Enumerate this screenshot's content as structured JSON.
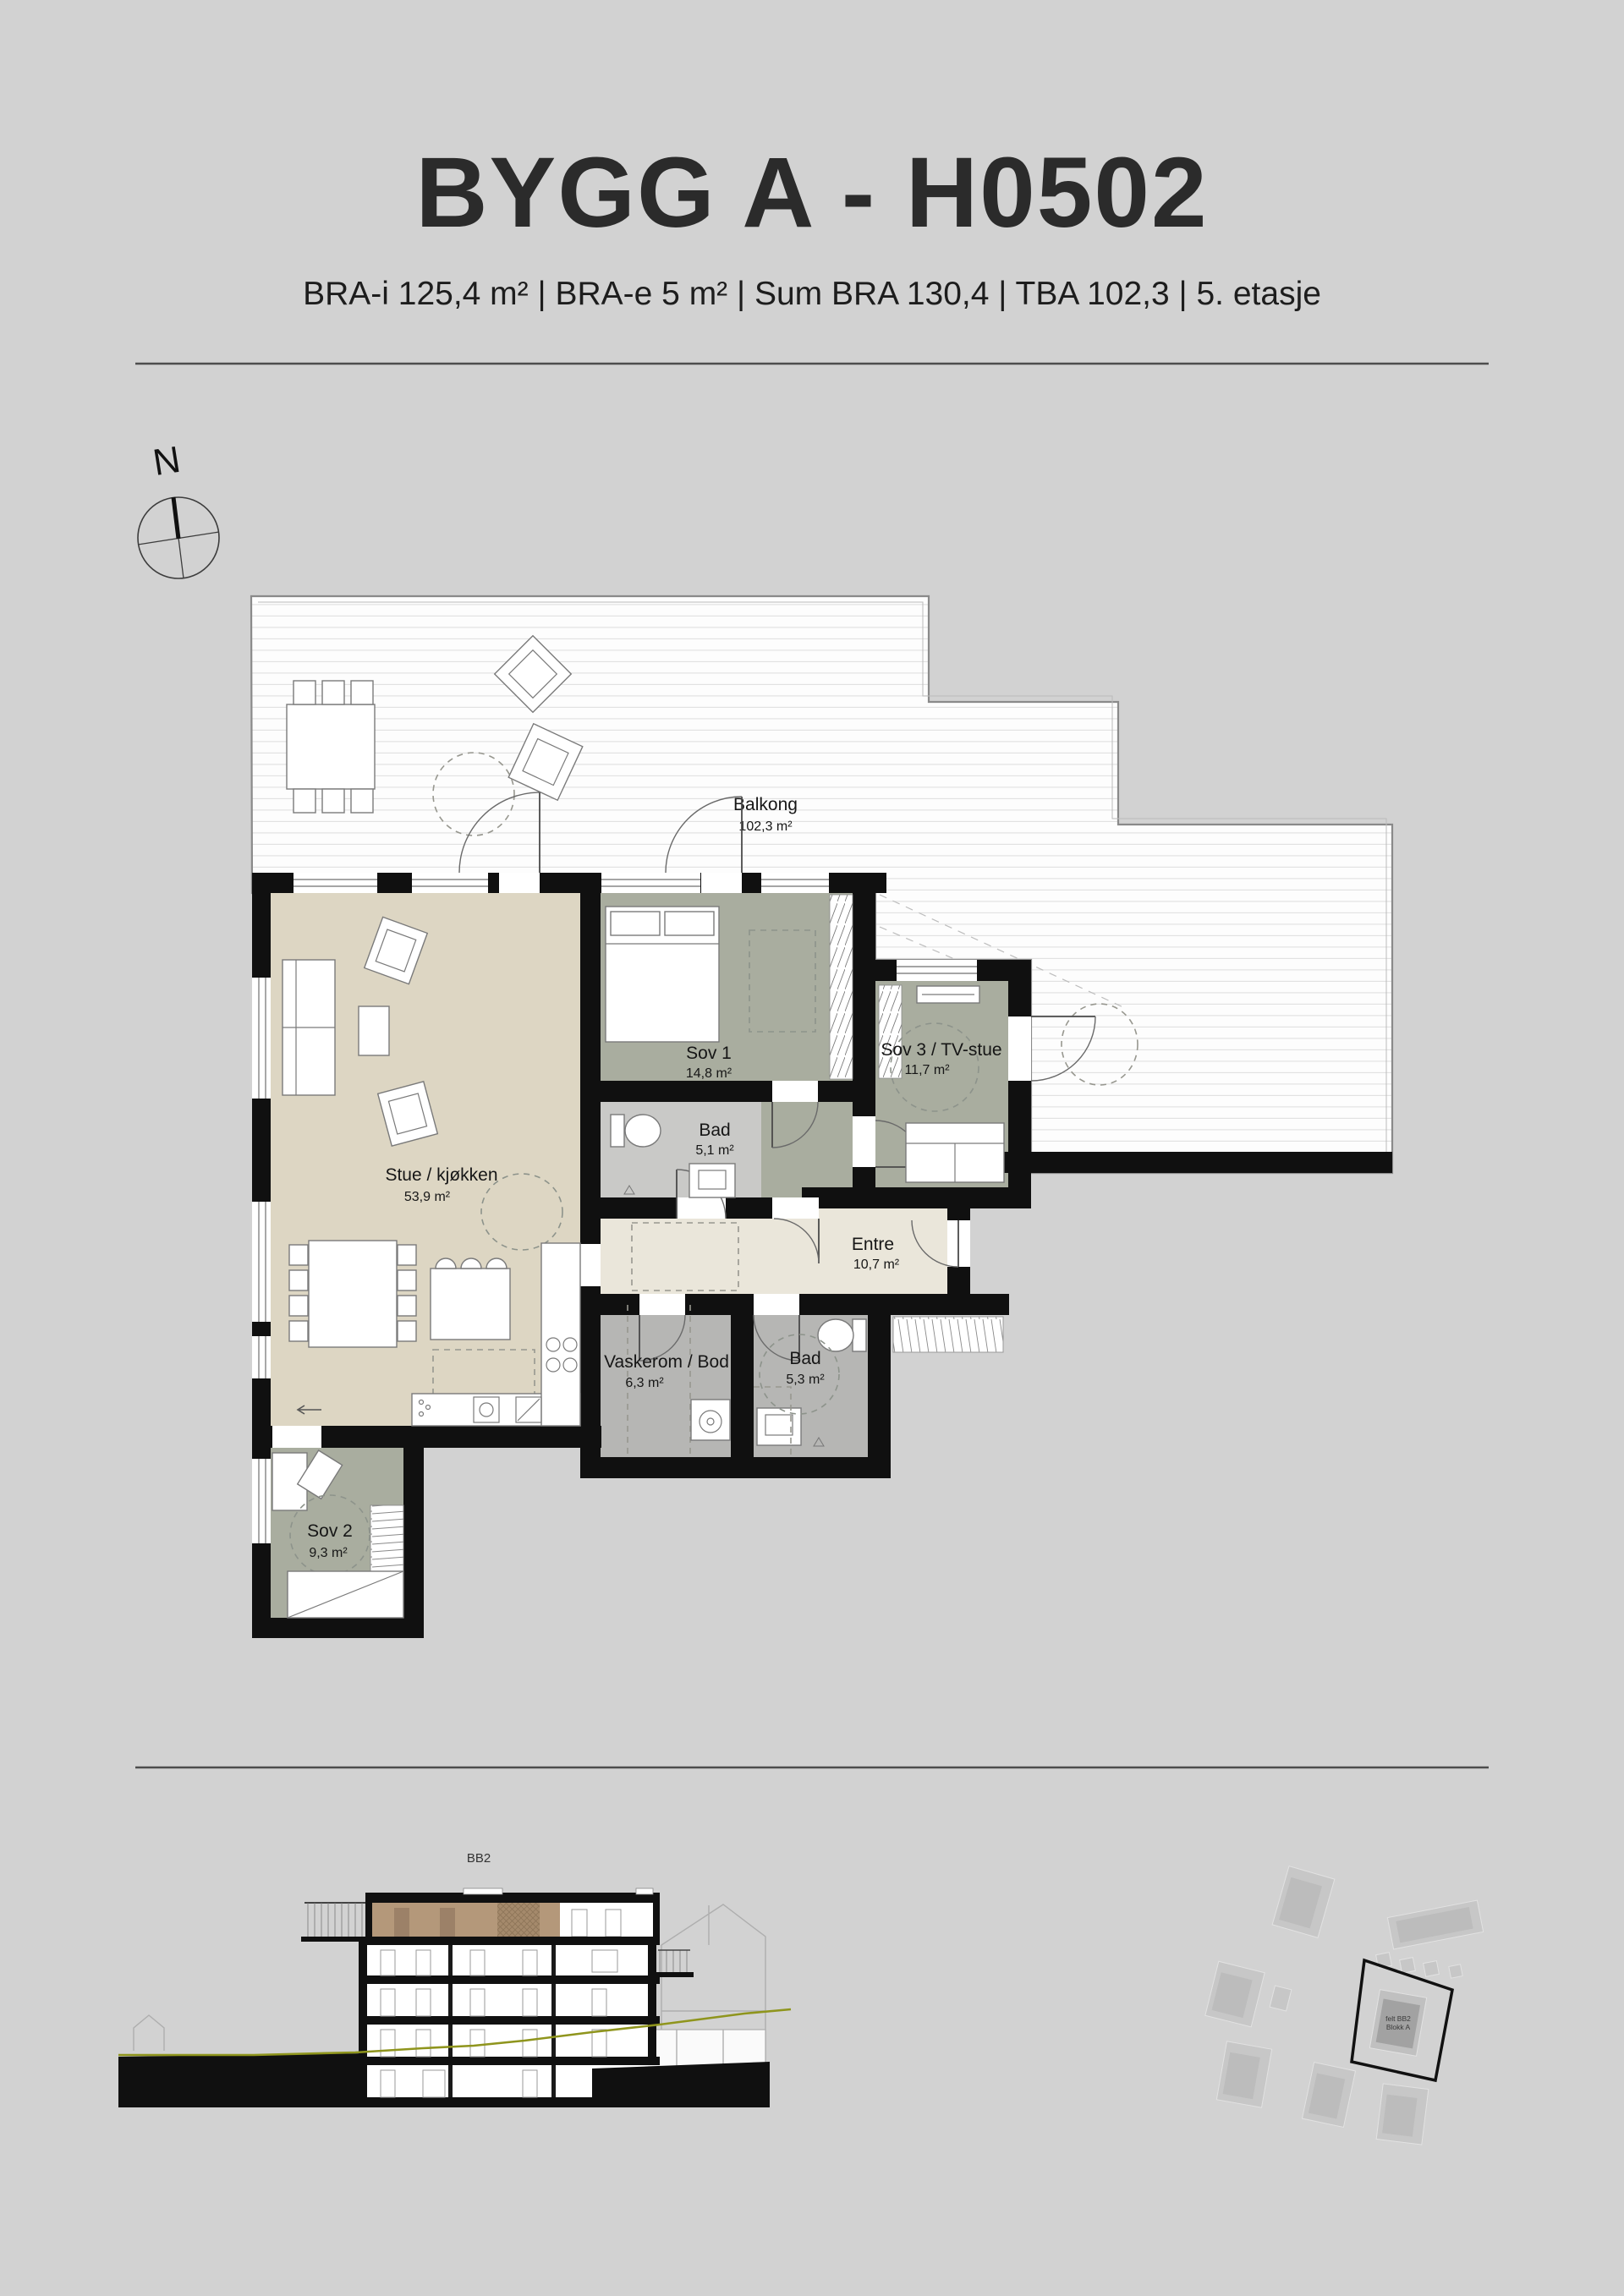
{
  "header": {
    "title": "BYGG A  - H0502",
    "subtitle": "BRA-i 125,4 m²  |  BRA-e 5 m²   |  Sum BRA 130,4  |  TBA 102,3  |  5. etasje",
    "area_segments": [
      "BRA-i 125,4 m²",
      "BRA-e 5 m²",
      "Sum BRA 130,4",
      "TBA 102,3",
      "5. etasje"
    ],
    "divider": "|"
  },
  "compass": {
    "north_label": "N"
  },
  "floor_plan": {
    "rooms": [
      {
        "id": "balkong",
        "name": "Balkong",
        "area": "102,3 m²"
      },
      {
        "id": "stue",
        "name": "Stue / kjøkken",
        "area": "53,9 m²"
      },
      {
        "id": "sov1",
        "name": "Sov 1",
        "area": "14,8 m²"
      },
      {
        "id": "bad1",
        "name": "Bad",
        "area": "5,1 m²"
      },
      {
        "id": "sov3",
        "name": "Sov 3 / TV-stue",
        "area": "11,7 m²"
      },
      {
        "id": "entre",
        "name": "Entre",
        "area": "10,7 m²"
      },
      {
        "id": "vaskerom",
        "name": "Vaskerom / Bod",
        "area": "6,3 m²"
      },
      {
        "id": "bad2",
        "name": "Bad",
        "area": "5,3 m²"
      },
      {
        "id": "sov2",
        "name": "Sov 2",
        "area": "9,3 m²"
      }
    ]
  },
  "section": {
    "label": "BB2"
  },
  "site_plan": {
    "highlighted_building": {
      "line1": "felt BB2",
      "line2": "Blokk A"
    }
  },
  "colors": {
    "page_bg": "#d2d2d2",
    "wall": "#101010",
    "living_kitchen": "#ddd6c3",
    "bedroom": "#a9ad9f",
    "bath_light": "#c9c9c7",
    "bath_mid": "#b6b6b4",
    "entre": "#eae6da",
    "deck_border": "#8a8a8a",
    "terrain_line": "#8f951d",
    "section_top_floor": "#b4987a",
    "site_building": "#c7c7c7",
    "site_highlight": "#a2a2a2"
  }
}
